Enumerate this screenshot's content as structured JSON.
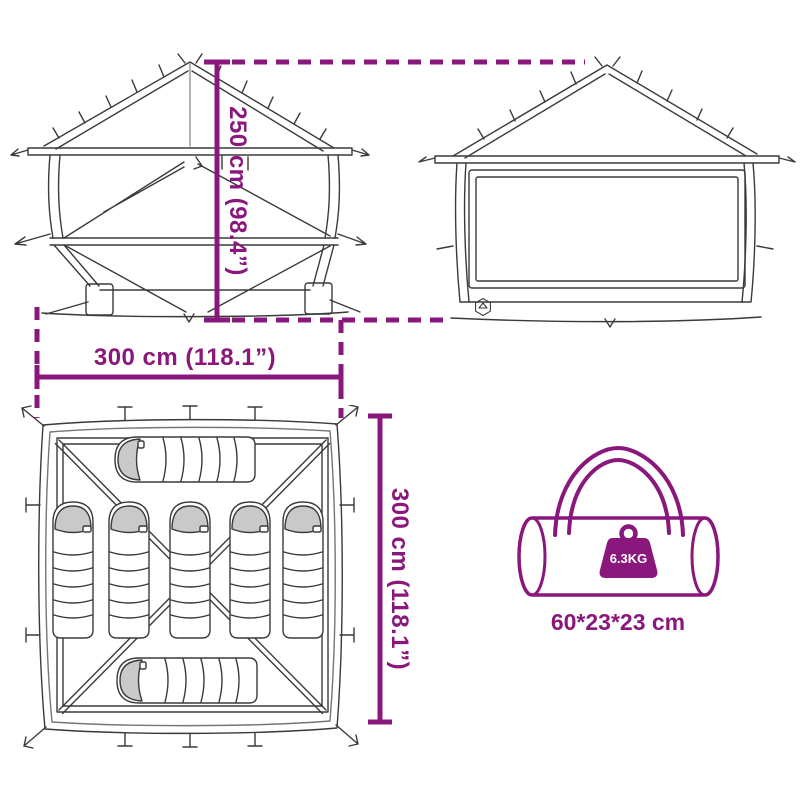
{
  "colors": {
    "accent": "#8A177B",
    "line": "#3A3A3A",
    "shade": "#C9C9C9",
    "bg": "#FFFFFF",
    "weight_text": "#FFFFFF"
  },
  "labels": {
    "tent_height": "250 cm (98.4”)",
    "tent_width": "300 cm (118.1”)",
    "tent_depth": "300 cm (118.1”)",
    "bag_weight": "6.3KG",
    "bag_size": "60*23*23 cm"
  },
  "illustrations": {
    "front_view": "tent-front-elevation-line-art",
    "side_view": "tent-side-elevation-line-art",
    "top_view": "tent-floor-plan-line-art",
    "sleeping_bag_count": 7,
    "carry_bag": "duffel-carry-bag-line-art",
    "weight_icon": "weight-block-icon",
    "brand_badge": "hexagon-logo-badge"
  }
}
